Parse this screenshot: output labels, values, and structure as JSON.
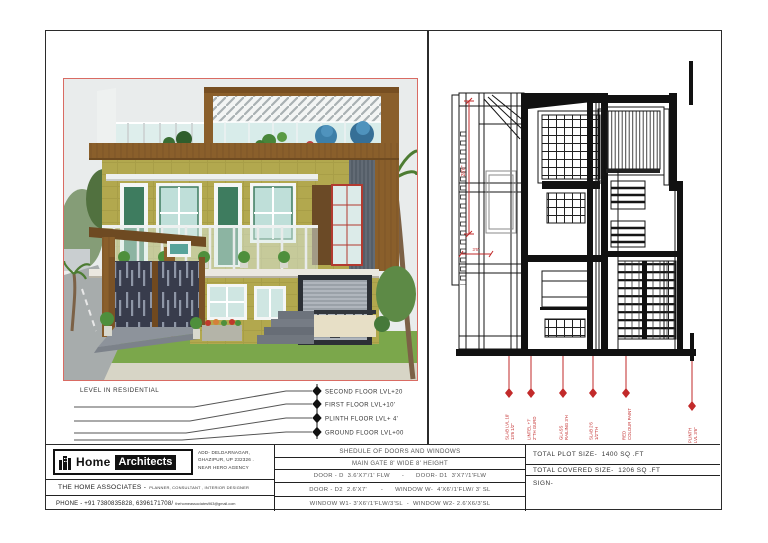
{
  "colors": {
    "accent_red": "#c03030",
    "wall_olive": "#b2a84e",
    "frame_brown": "#8a5f2b",
    "line_black": "#1a1a1a"
  },
  "levels": {
    "heading": "LEVEL IN RESIDENTIAL",
    "items": [
      {
        "label": "SECOND FLOOR LVL+20"
      },
      {
        "label": "FIRST FLOOR LVL+10'"
      },
      {
        "label": "PLINTH FLOOR LVL+ 4'"
      },
      {
        "label": "GROUND FLOOR LVL+00"
      }
    ]
  },
  "schedule": {
    "title": "SHEDULE OF DOORS AND WINDOWS",
    "rows": [
      "MAIN GATE 8' WIDE 8' HEIGHT",
      "DOOR - D  3.6'X7'/1' FLW      -      DOOR- D1  3'X7'/1'FLW",
      "DOOR - D2  2.6'X7'       -      WINDOW W-  4'X6'/1'FLW/ 3' SL",
      "WINDOW W1- 3'X6'/1'FLW/3'SL  -  WINDOW W2- 2.6'X6/3'SL"
    ]
  },
  "totals": {
    "plot": "TOTAL PLOT SIZE-  1400 SQ .FT",
    "covered": "TOTAL COVERED SIZE-  1206 SQ .FT",
    "sign": "SIGN-"
  },
  "firm": {
    "logo_home": "Home",
    "logo_architects": "Architects",
    "address1": "ADD- DELDARNAGAR,",
    "address2": "GHAZIPUR, UP 232326 .",
    "address3": "NEAR HERO AGENCY",
    "associates_name": "THE HOME ASSOCIATES -",
    "associates_roles": "PLANNER, CONSULTANT , INTERIOR DESIGNER",
    "phone": "PHONE -   +91 7380835828, 6396171708/",
    "email": "thehomeassociates963@gmail.com"
  },
  "elevation": {
    "dim_vertical": "28'6\"",
    "dim_horizontal": "3'6\"",
    "labels": [
      {
        "line1": "SLAB LVL 10'",
        "line2": "13'6 1/2\""
      },
      {
        "line1": "LINTEL +7'",
        "line2": "2\"TH GURD"
      },
      {
        "line1": "GLASS",
        "line2": "RAILING 3'H"
      },
      {
        "line1": "SLAB 2'6",
        "line2": "1/2\"TH"
      },
      {
        "line1": "RED",
        "line2": "COLOUR PAINT"
      },
      {
        "line1": "PLINTH",
        "line2": "LVL 3'6\""
      }
    ]
  }
}
